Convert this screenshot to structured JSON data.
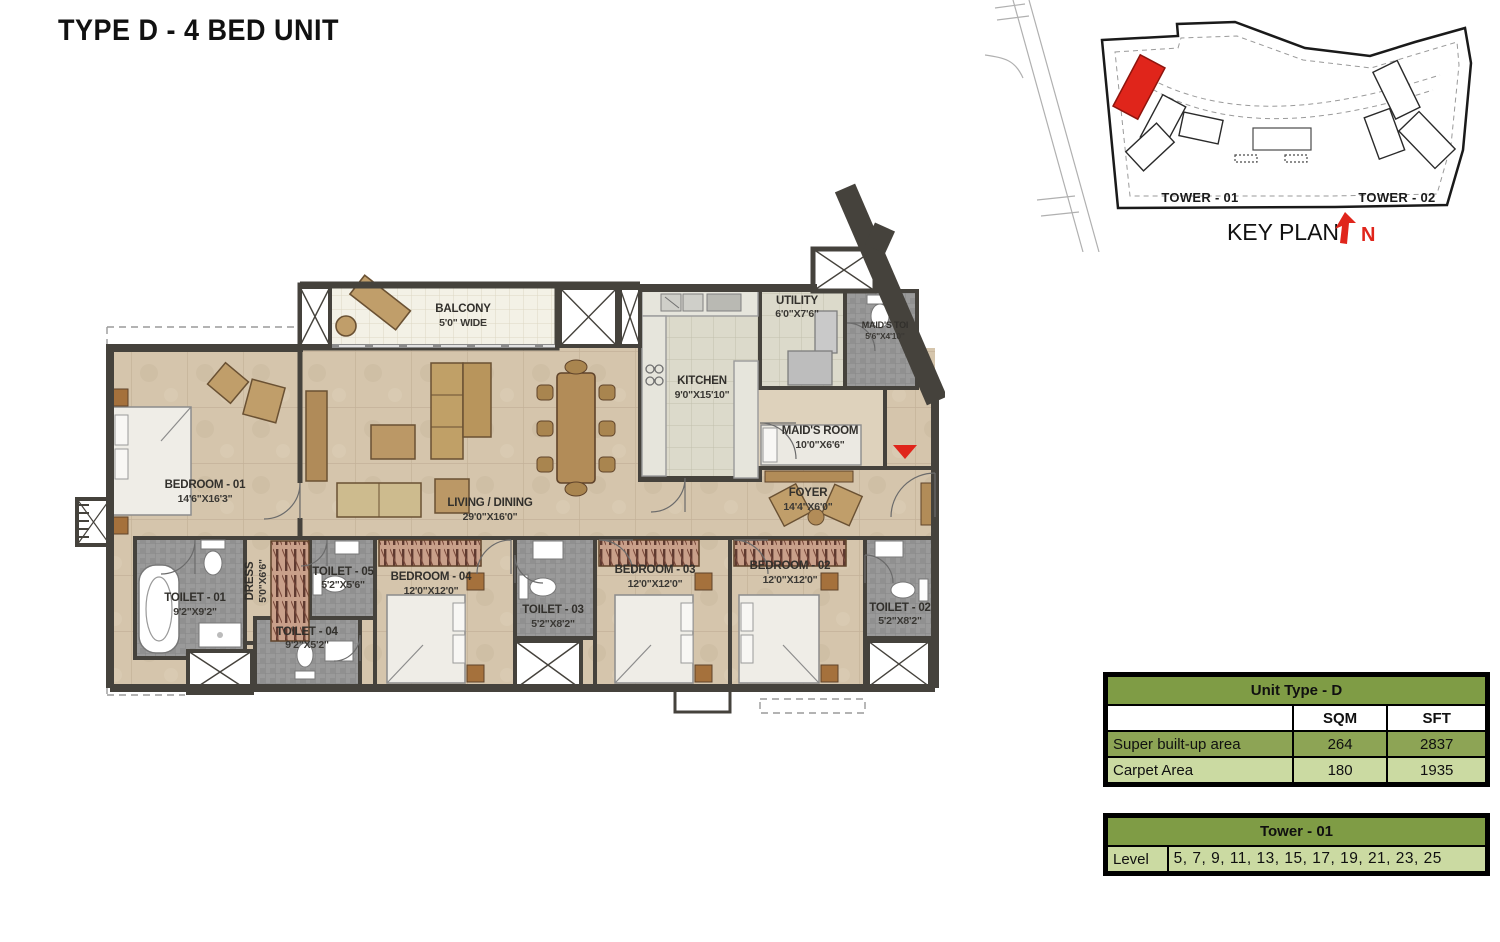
{
  "title": "TYPE D - 4 BED UNIT",
  "key_plan": {
    "label": "KEY PLAN",
    "north_label": "N",
    "tower1_label": "TOWER - 01",
    "tower2_label": "TOWER - 02"
  },
  "rooms": {
    "balcony": {
      "name": "BALCONY",
      "dim": "5'0\" WIDE"
    },
    "bedroom01": {
      "name": "BEDROOM - 01",
      "dim": "14'6\"X16'3\""
    },
    "living": {
      "name": "LIVING / DINING",
      "dim": "29'0\"X16'0\""
    },
    "kitchen": {
      "name": "KITCHEN",
      "dim": "9'0\"X15'10\""
    },
    "utility": {
      "name": "UTILITY",
      "dim": "6'0\"X7'6\""
    },
    "maids_toilet": {
      "name": "MAID'S TOI",
      "dim": "5'6\"X4'10\""
    },
    "maids_room": {
      "name": "MAID'S ROOM",
      "dim": "10'0\"X6'6\""
    },
    "foyer": {
      "name": "FOYER",
      "dim": "14'4\"X6'0\""
    },
    "toilet01": {
      "name": "TOILET - 01",
      "dim": "9'2\"X9'2\""
    },
    "dress": {
      "name": "DRESS",
      "dim": "5'0\"X6'6\""
    },
    "toilet05": {
      "name": "TOILET - 05",
      "dim": "5'2\"X5'6\""
    },
    "toilet04": {
      "name": "TOILET - 04",
      "dim": "9'2\"X5'2\""
    },
    "bedroom04": {
      "name": "BEDROOM - 04",
      "dim": "12'0\"X12'0\""
    },
    "toilet03": {
      "name": "TOILET - 03",
      "dim": "5'2\"X8'2\""
    },
    "bedroom03": {
      "name": "BEDROOM - 03",
      "dim": "12'0\"X12'0\""
    },
    "bedroom02": {
      "name": "BEDROOM - 02",
      "dim": "12'0\"X12'0\""
    },
    "toilet02": {
      "name": "TOILET - 02",
      "dim": "5'2\"X8'2\""
    }
  },
  "unit_table": {
    "title": "Unit Type - D",
    "col_headers": [
      "SQM",
      "SFT"
    ],
    "rows": [
      {
        "label": "Super built-up area",
        "sqm": "264",
        "sft": "2837"
      },
      {
        "label": "Carpet Area",
        "sqm": "180",
        "sft": "1935"
      }
    ]
  },
  "tower_table": {
    "title": "Tower - 01",
    "row_label": "Level",
    "row_value": "5, 7, 9, 11, 13, 15, 17, 19, 21, 23, 25"
  },
  "colors": {
    "accent_red": "#e0251b",
    "table_olive": "#7f9c45",
    "table_row_olive": "#8da455",
    "table_row_light": "#cbdaa2",
    "wall": "#45423c",
    "floor": "#d5c5ac",
    "toilet_floor": "#9a9a9a"
  }
}
